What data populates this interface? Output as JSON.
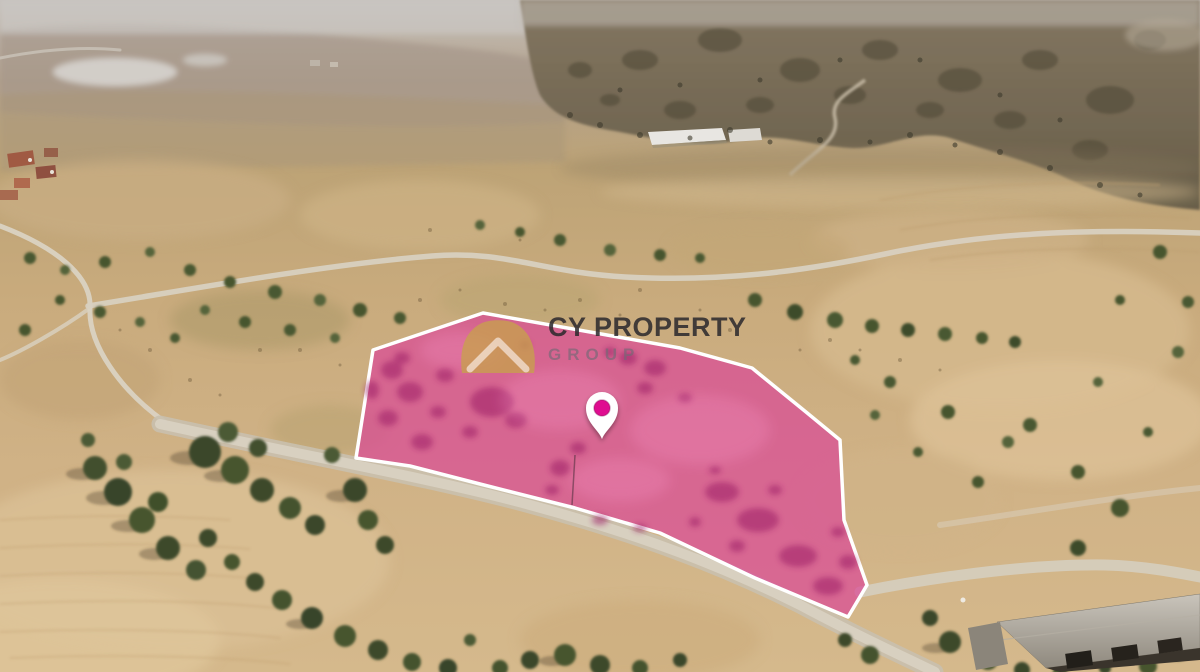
{
  "watermark": {
    "line1": "CY PROPERTY",
    "line2": "GROUP"
  },
  "marker": {
    "icon": "location-pin"
  },
  "logo": {
    "icon": "gold-roof-chevron-mark"
  },
  "colors": {
    "plot_fill": "#d94a96",
    "plot_border": "#ffffff",
    "pin_dot": "#df1190",
    "logo_gold": "#c7a14c",
    "title_text": "#2a272c",
    "subtitle_text": "#6f6a75"
  }
}
